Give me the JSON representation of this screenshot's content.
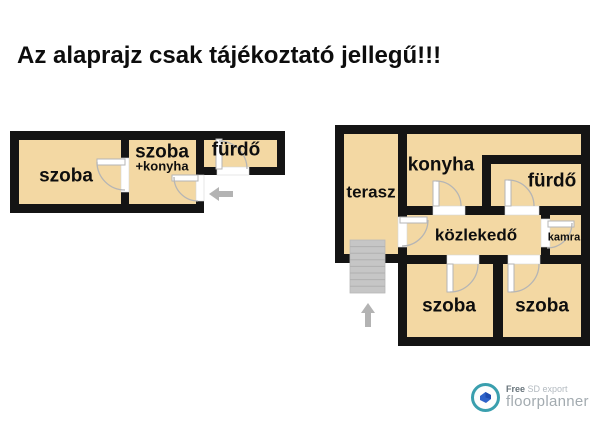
{
  "title": "Az alaprajz csak tájékoztató jellegű!!!",
  "plan_left": {
    "rooms": {
      "szoba": "szoba",
      "szoba_konyha": "szoba",
      "szoba_konyha_sub": "+konyha",
      "furdo": "fürdő"
    }
  },
  "plan_right": {
    "rooms": {
      "terasz": "terasz",
      "konyha": "konyha",
      "furdo": "fürdő",
      "kozlekedo": "közlekedő",
      "kamra": "kamra",
      "szoba_left": "szoba",
      "szoba_right": "szoba"
    }
  },
  "branding": {
    "free": "Free",
    "export_type": "SD export",
    "name": "floorplanner"
  },
  "colors": {
    "room_fill": "#f3d8a3",
    "wall": "#141414",
    "door_stroke": "#b5b5b5",
    "stairs_fill": "#c6c6c6",
    "arrow_fill": "#b3b3b3",
    "logo_teal": "#3a9fae",
    "logo_blue": "#2e62c9",
    "logo_text": "#a3abb0"
  }
}
